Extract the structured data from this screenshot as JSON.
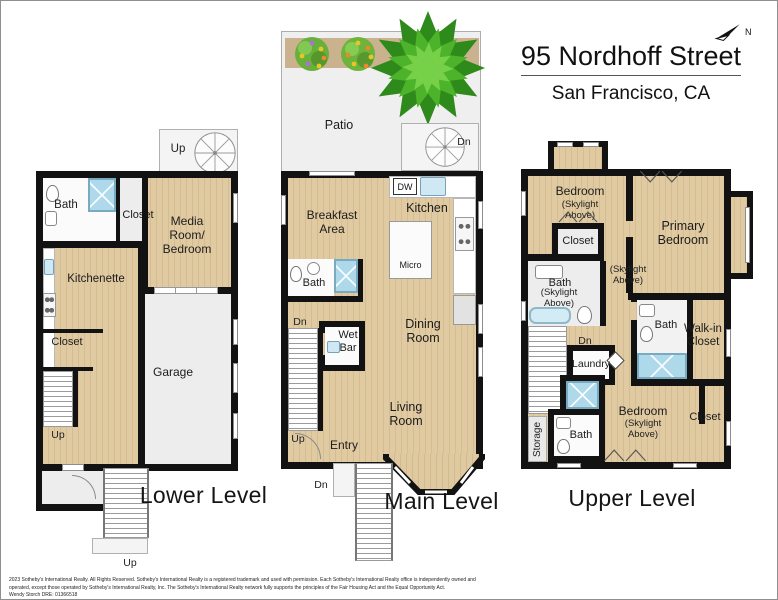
{
  "header": {
    "title": "95 Nordhoff Street",
    "subtitle": "San Francisco, CA",
    "compass": "N"
  },
  "levels": {
    "lower": {
      "name": "Lower Level",
      "rooms": {
        "bath": "Bath",
        "closet_top": "Closet",
        "media": "Media Room/ Bedroom",
        "kitchenette": "Kitchenette",
        "closet_mid": "Closet",
        "garage": "Garage"
      },
      "stairs": {
        "spiral_up": "Up",
        "interior_up": "Up",
        "exterior_up": "Up"
      }
    },
    "main": {
      "name": "Main Level",
      "rooms": {
        "patio": "Patio",
        "breakfast": "Breakfast Area",
        "kitchen": "Kitchen",
        "bath": "Bath",
        "wet_bar": "Wet Bar",
        "dining": "Dining Room",
        "living": "Living Room",
        "entry": "Entry"
      },
      "appliances": {
        "dw": "DW",
        "micro": "Micro"
      },
      "stairs": {
        "spiral_dn": "Dn",
        "interior_dn": "Dn",
        "interior_up": "Up",
        "exterior_dn": "Dn"
      }
    },
    "upper": {
      "name": "Upper Level",
      "rooms": {
        "bedroom1": "Bedroom",
        "bedroom1_note": "(Skylight Above)",
        "closet1": "Closet",
        "primary": "Primary Bedroom",
        "bath1": "Bath",
        "bath1_note": "(Skylight Above)",
        "hall_note": "(Skylight Above)",
        "laundry": "Laundry",
        "bath2": "Bath",
        "walkin": "Walk-in Closet",
        "bedroom2": "Bedroom",
        "bedroom2_note": "(Skylight Above)",
        "closet2": "Closet",
        "storage": "Storage",
        "bath3": "Bath"
      },
      "stairs": {
        "dn": "Dn"
      }
    }
  },
  "footer": {
    "line1": "2023 Sotheby's International Realty. All Rights Reserved. Sotheby's International Realty is a registered trademark and used with permission. Each Sotheby's International Realty office is independently owned and",
    "line2": "operated, except those operated by Sotheby's International Realty, Inc. The Sotheby's International Realty network fully supports the principles of the Fair Housing Act and the Equal Opportunity Act.",
    "line3": "Wendy Storch DRE: 01366518"
  }
}
